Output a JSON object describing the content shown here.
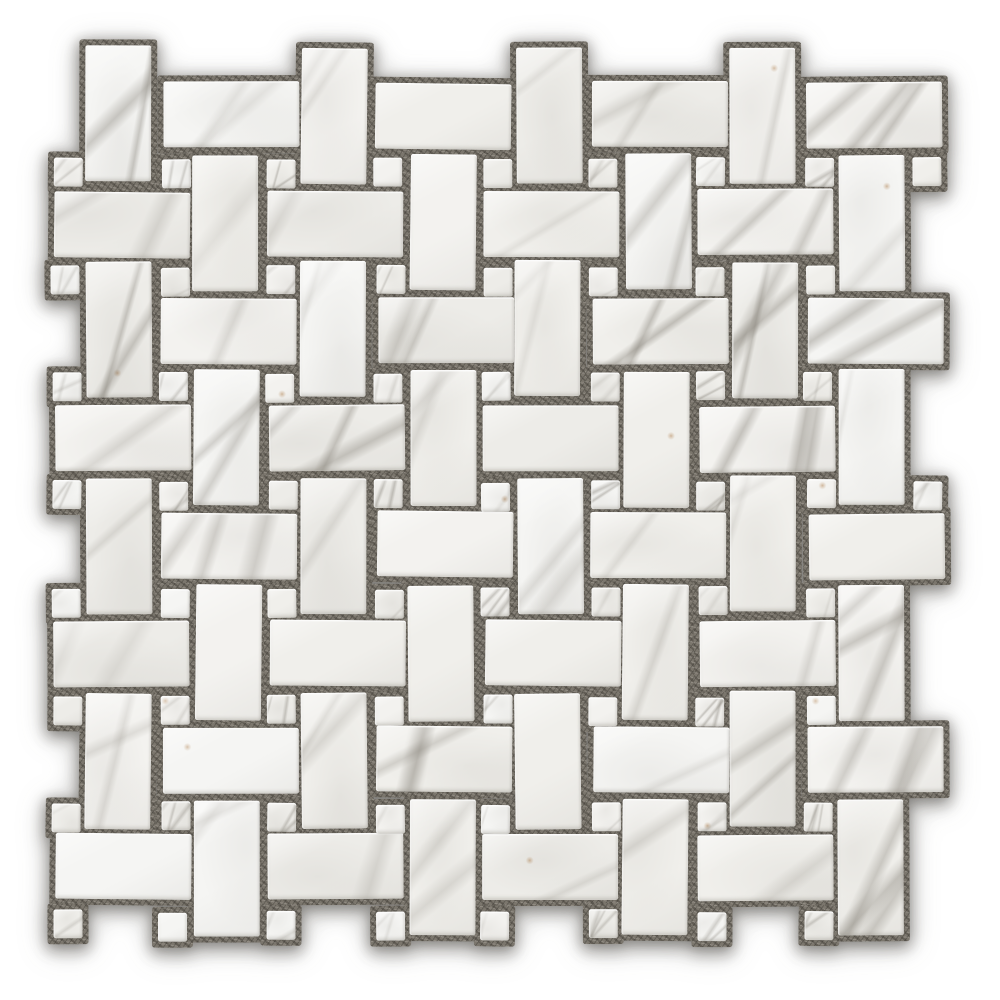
{
  "scene": {
    "type": "product-photo",
    "subject": "white marble basketweave mosaic tile sheet with square dots and gray grout",
    "background_color": "#ffffff"
  },
  "mosaic": {
    "canvas": {
      "width": 1000,
      "height": 1000
    },
    "pattern": "basketweave-with-dot",
    "lattice": {
      "step": 107.5
    },
    "vertical_rect": {
      "anchor_x": 86,
      "anchor_y": 47,
      "width": 66,
      "height": 136,
      "row_min": 0,
      "row_max": 7,
      "cols_even_rows": [
        0,
        2,
        4,
        6
      ],
      "cols_odd_rows": [
        1,
        3,
        5,
        7
      ]
    },
    "horizontal_rect": {
      "anchor_x": 54,
      "anchor_y": 189.5,
      "width": 136,
      "height": 66,
      "row_min": -1,
      "row_max": 6,
      "cols_even_rows": [
        0,
        2,
        4,
        6
      ],
      "cols_odd_rows": [
        1,
        3,
        5,
        7
      ]
    },
    "dot": {
      "anchor_x": 52,
      "anchor_y": 158,
      "size": 29,
      "m_min": 0,
      "m_max": 7,
      "n_min": 0,
      "n_max": 7,
      "extra_cells": [
        [
          8,
          0
        ],
        [
          8,
          3
        ]
      ]
    },
    "counts": {
      "vertical_rects": 32,
      "horizontal_rects": 32,
      "dots": 66,
      "total_tiles": 130
    },
    "grout": {
      "pad": 6,
      "base_color": "#7b766d",
      "dark_speckle": "#39362f",
      "light_speckle": "#e4e0d8"
    },
    "marble": {
      "base_colors": [
        "#f3f2ef",
        "#f0efeb",
        "#edece8",
        "#f5f5f3"
      ],
      "vein_rgb": "113,108,98",
      "rust_rgb": "178,132,84",
      "vein_probability_faint": 0.45,
      "vein_probability_strong": 0.25,
      "rust_probability": 0.1
    },
    "jitter": {
      "seed": 12,
      "translate_px": 2,
      "rotate_deg": 0.7
    },
    "shadow_rgb": "68,65,59"
  }
}
